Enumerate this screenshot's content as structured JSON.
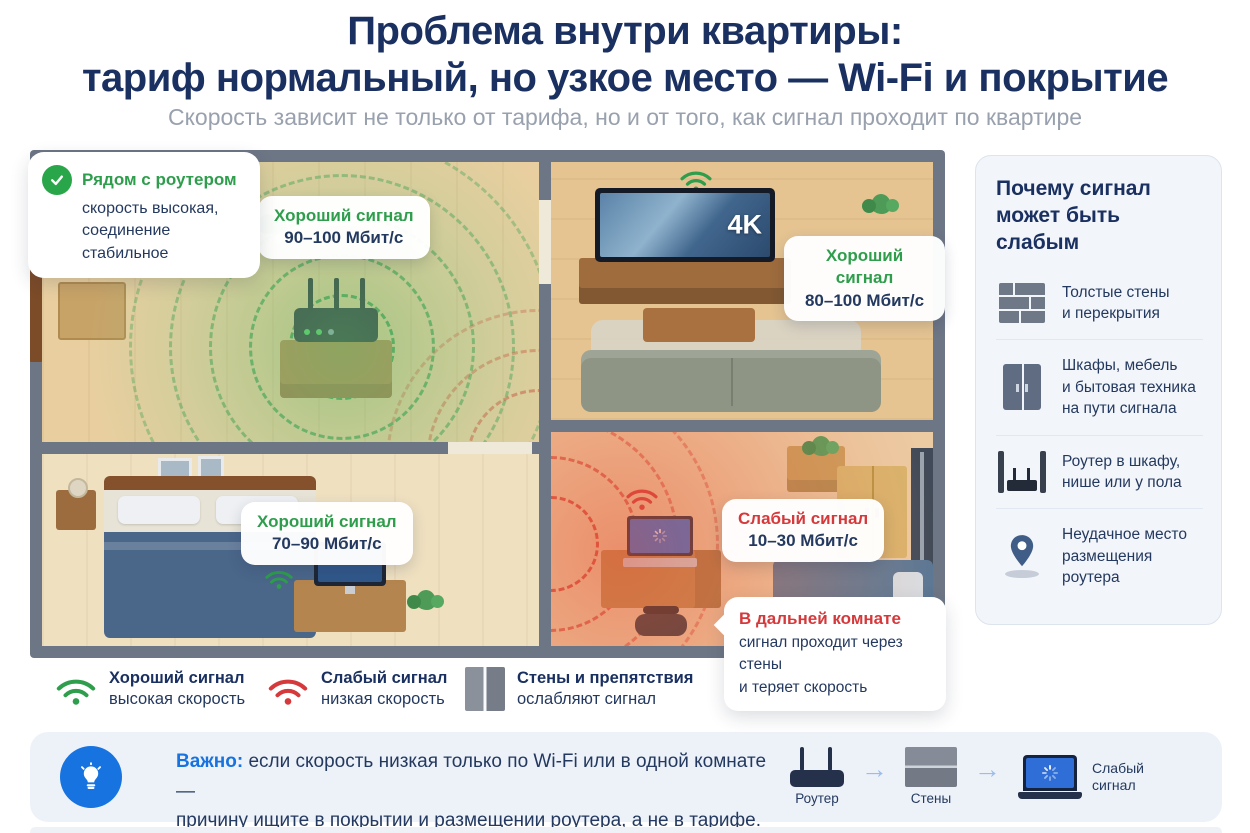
{
  "header": {
    "title": "Проблема внутри квартиры:\nтариф нормальный, но узкое место — Wi-Fi и покрытие",
    "subtitle": "Скорость зависит не только от тарифа, но и от того, как сигнал проходит по квартире"
  },
  "floorplan": {
    "router_callout": {
      "title": "Рядом с роутером",
      "body": "скорость высокая,\nсоединение стабильное"
    },
    "signal_labels": [
      {
        "room": "router-room",
        "status": "good",
        "title": "Хороший сигнал",
        "value": "90–100 Мбит/с"
      },
      {
        "room": "living-room",
        "status": "good",
        "title": "Хороший сигнал",
        "value": "80–100 Мбит/с"
      },
      {
        "room": "bedroom",
        "status": "good",
        "title": "Хороший сигнал",
        "value": "70–90 Мбит/с"
      },
      {
        "room": "far-room",
        "status": "weak",
        "title": "Слабый сигнал",
        "value": "10–30 Мбит/с"
      }
    ],
    "far_room_callout": {
      "title": "В дальней комнате",
      "body": "сигнал проходит через стены\nи теряет скорость"
    },
    "tv_badge": "4K"
  },
  "sidebar": {
    "title": "Почему сигнал\nможет быть слабым",
    "items": [
      {
        "icon": "brick-wall-icon",
        "text": "Толстые стены\nи перекрытия"
      },
      {
        "icon": "wardrobe-icon",
        "text": "Шкафы, мебель\nи бытовая техника\nна пути сигнала"
      },
      {
        "icon": "router-in-niche-icon",
        "text": "Роутер в шкафу,\nнише или у пола"
      },
      {
        "icon": "location-pin-icon",
        "text": "Неудачное место\nразмещения роутера"
      }
    ]
  },
  "legend": [
    {
      "icon": "wifi-good-icon",
      "title": "Хороший сигнал",
      "subtitle": "высокая скорость"
    },
    {
      "icon": "wifi-weak-icon",
      "title": "Слабый сигнал",
      "subtitle": "низкая скорость"
    },
    {
      "icon": "wall-icon",
      "title": "Стены и препятствия",
      "subtitle": "ослабляют сигнал"
    }
  ],
  "banner": {
    "important_label": "Важно:",
    "text": "если скорость низкая только по Wi-Fi или в одной комнате —\nпричину ищите в покрытии и размещении роутера, а не в тарифе.",
    "steps": [
      {
        "icon": "router-icon",
        "label": "Роутер"
      },
      {
        "icon": "walls-icon",
        "label": "Стены"
      },
      {
        "icon": "laptop-loading-icon",
        "label": "Слабый\nсигнал"
      }
    ]
  },
  "colors": {
    "navy": "#1a3060",
    "good_green": "#2e9e4c",
    "weak_red": "#d5393b",
    "accent_blue": "#1673e0",
    "wall_gray": "#6d7685"
  }
}
